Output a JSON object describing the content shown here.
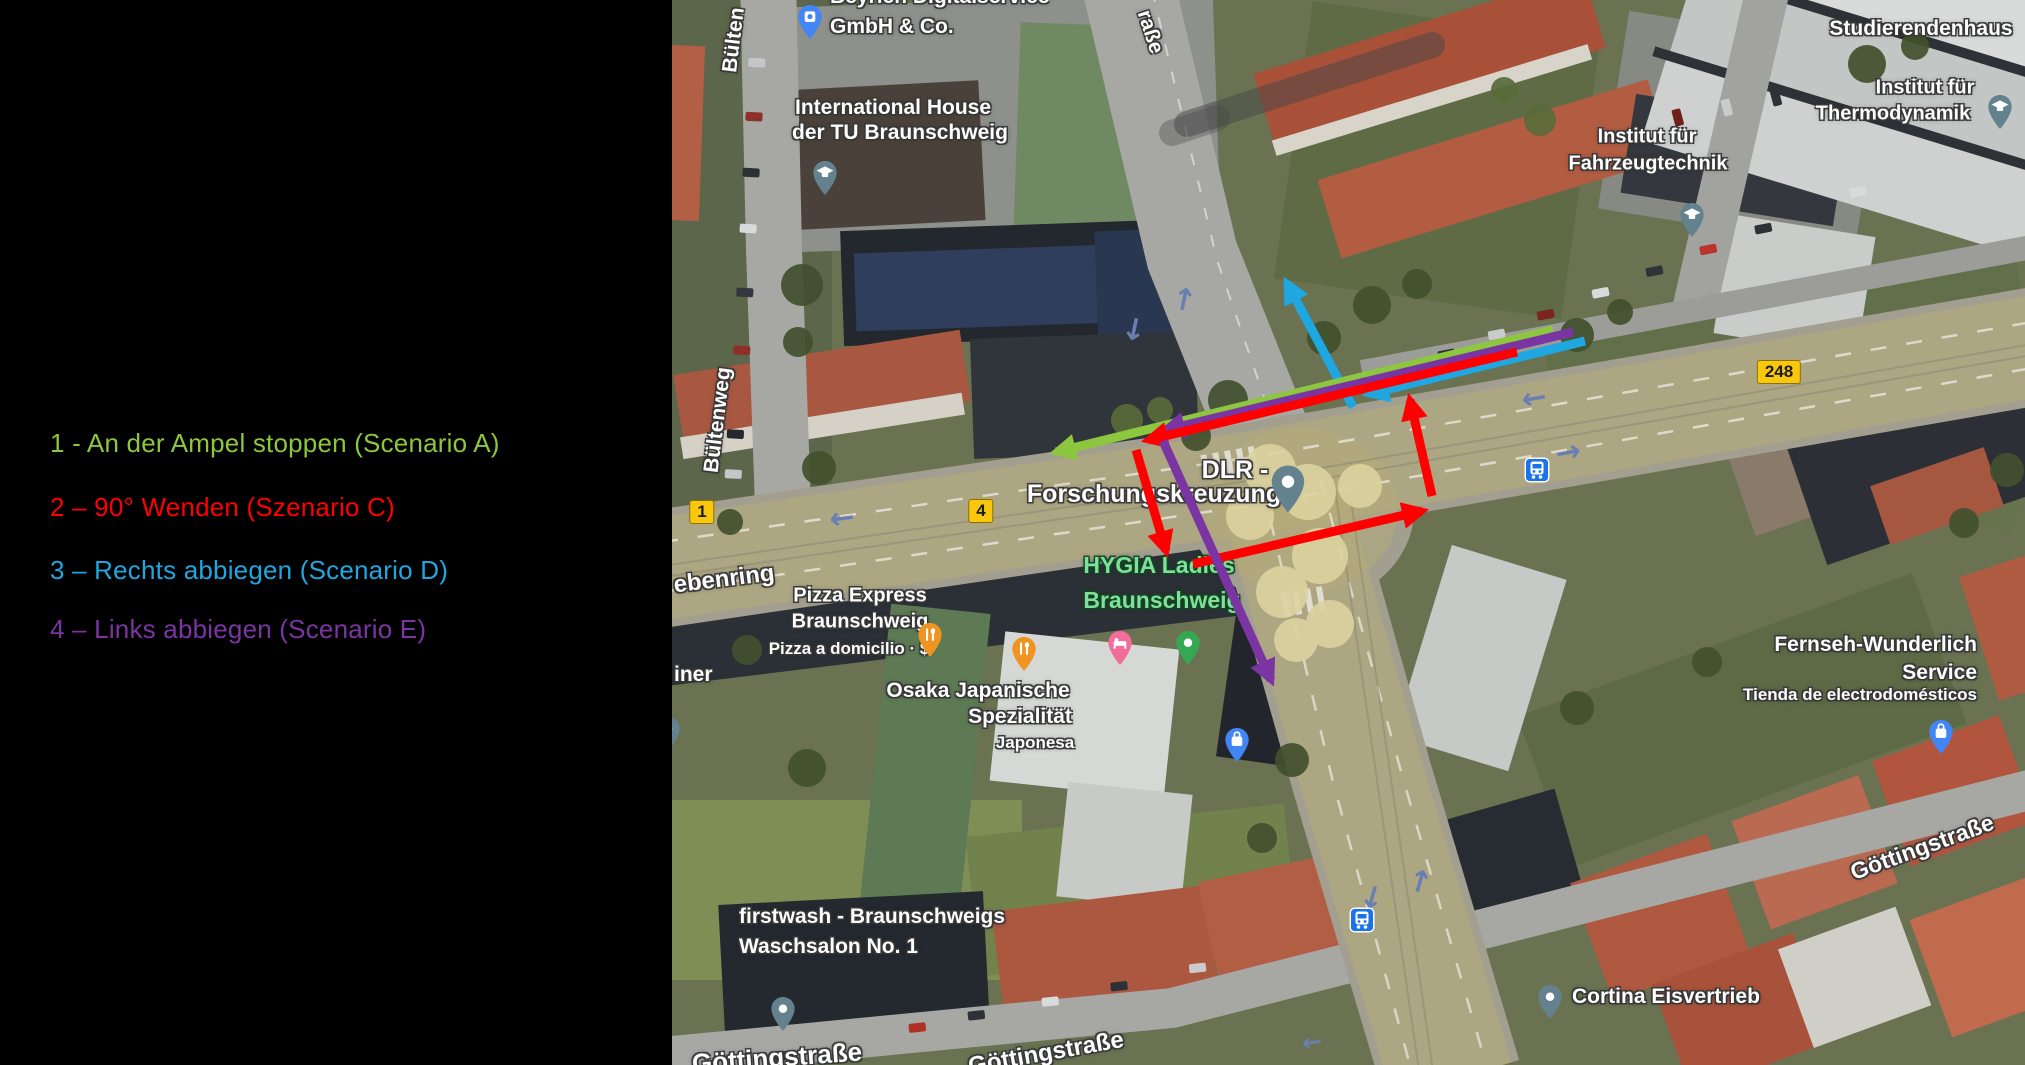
{
  "legend": {
    "items": [
      {
        "text": "1 - An der Ampel stoppen (Scenario A)",
        "color": "#8dc63f"
      },
      {
        "text": "2 – 90° Wenden (Szenario C)",
        "color": "#fe0000"
      },
      {
        "text": "3 – Rechts abbiegen (Scenario D)",
        "color": "#1ea7e1"
      },
      {
        "text": "4 – Links abbiegen (Scenario E)",
        "color": "#7a35a3"
      }
    ]
  },
  "map": {
    "pois": {
      "beyrich": {
        "lines": [
          "Beyrich Digitalservice",
          "GmbH & Co."
        ]
      },
      "international_house": {
        "lines": [
          "International House",
          "der TU Braunschweig"
        ]
      },
      "fahrzeugtechnik": {
        "lines": [
          "Institut für",
          "Fahrzeugtechnik"
        ]
      },
      "thermodynamik": {
        "lines": [
          "Institut für",
          "Thermodynamik"
        ]
      },
      "studierendenhaus": {
        "lines": [
          "Studierendenhaus"
        ]
      },
      "dlr": {
        "lines": [
          "DLR -",
          "Forschungskreuzung"
        ]
      },
      "hygia": {
        "lines": [
          "HYGIA Ladies",
          "Braunschweig"
        ],
        "color": "#7ee09a"
      },
      "pizza_express": {
        "lines": [
          "Pizza Express",
          "Braunschweig",
          "Pizza a domicilio · $"
        ]
      },
      "osaka": {
        "lines": [
          "Osaka Japanische",
          "Spezialität",
          "Japonesa"
        ]
      },
      "firstwash": {
        "lines": [
          "firstwash - Braunschweigs",
          "Waschsalon No. 1"
        ]
      },
      "fernseh": {
        "lines": [
          "Fernseh-Wunderlich",
          "Service",
          "Tienda de electrodomésticos"
        ]
      },
      "cortina": {
        "lines": [
          "Cortina Eisvertrieb"
        ]
      },
      "iner": {
        "lines": [
          "iner"
        ]
      }
    },
    "streets": {
      "bueltenweg": "Bültenweg",
      "bueltenweg_fragment": "Bülten",
      "strasse_fragment": "raße",
      "rebenring_fragment": "ebenring",
      "goettingstrasse": "Göttingstraße"
    },
    "route_badges": {
      "b1": "1",
      "b4": "4",
      "b248": "248"
    },
    "icon_colors": {
      "poi_gray": "#64828e",
      "education": "#64828e",
      "restaurant": "#f09421",
      "hotel": "#f26d9b",
      "store_blue": "#4285f4",
      "place_blue": "#4285f4",
      "green_poi": "#34a853",
      "transit": "#1a73e8",
      "badge_bg": "#f9c80e"
    }
  }
}
